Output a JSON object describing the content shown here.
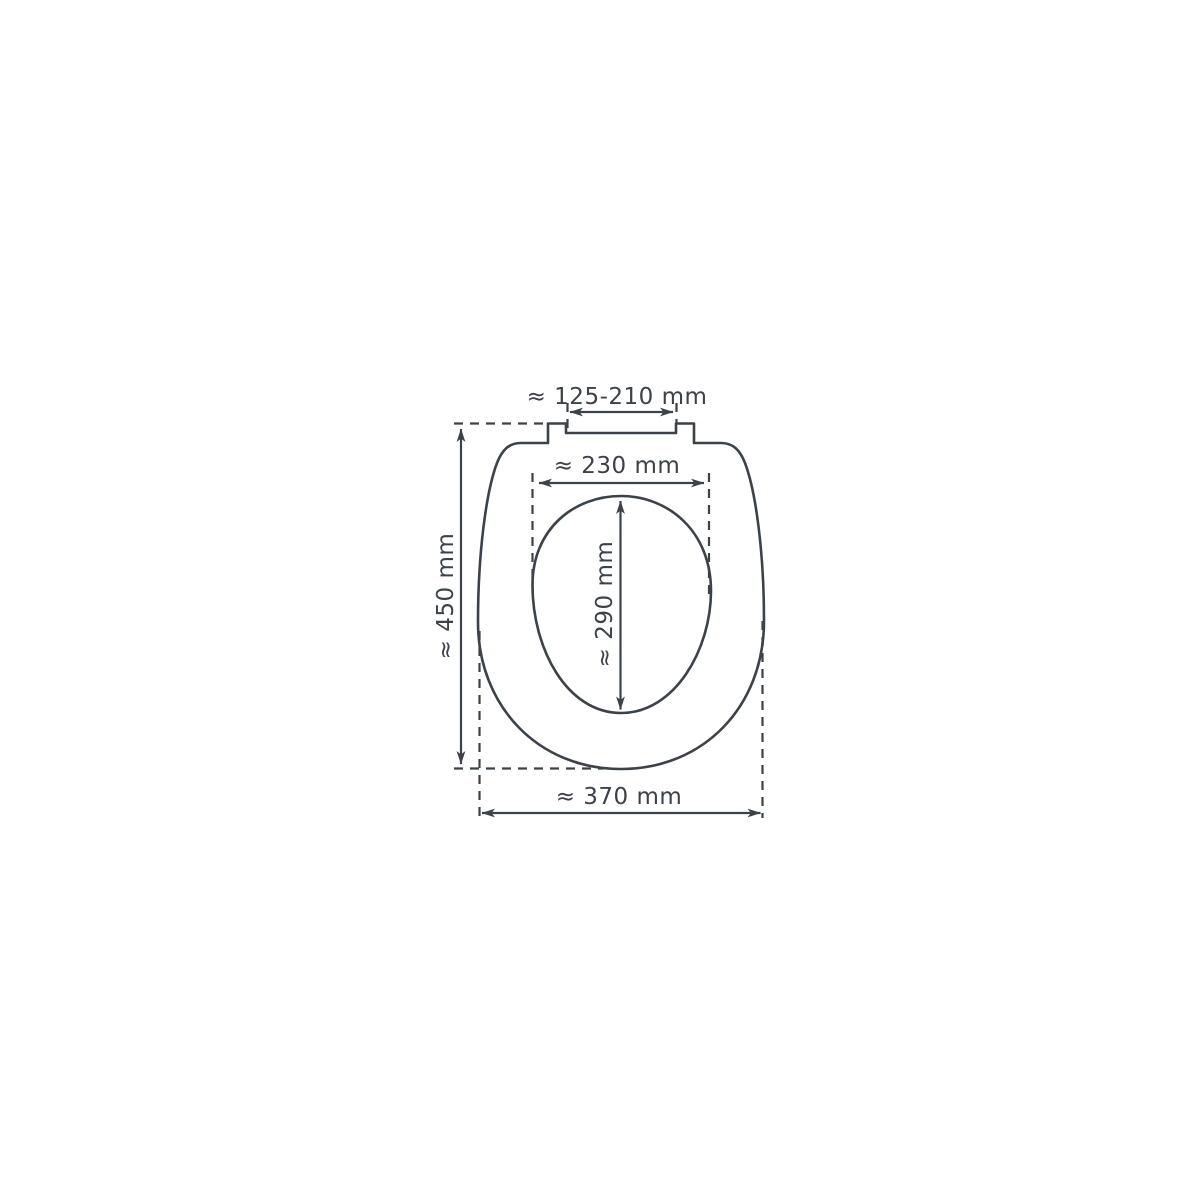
{
  "diagram": {
    "subject": "toilet-seat-dimension-drawing-top-view",
    "colors": {
      "line": "#3c4249",
      "background": "#ffffff"
    },
    "dimensions": {
      "hinge_width": "≈ 125-210 mm",
      "inner_width": "≈ 230 mm",
      "inner_length": "≈ 290 mm",
      "outer_length": "≈ 450 mm",
      "outer_width": "≈ 370 mm"
    }
  }
}
